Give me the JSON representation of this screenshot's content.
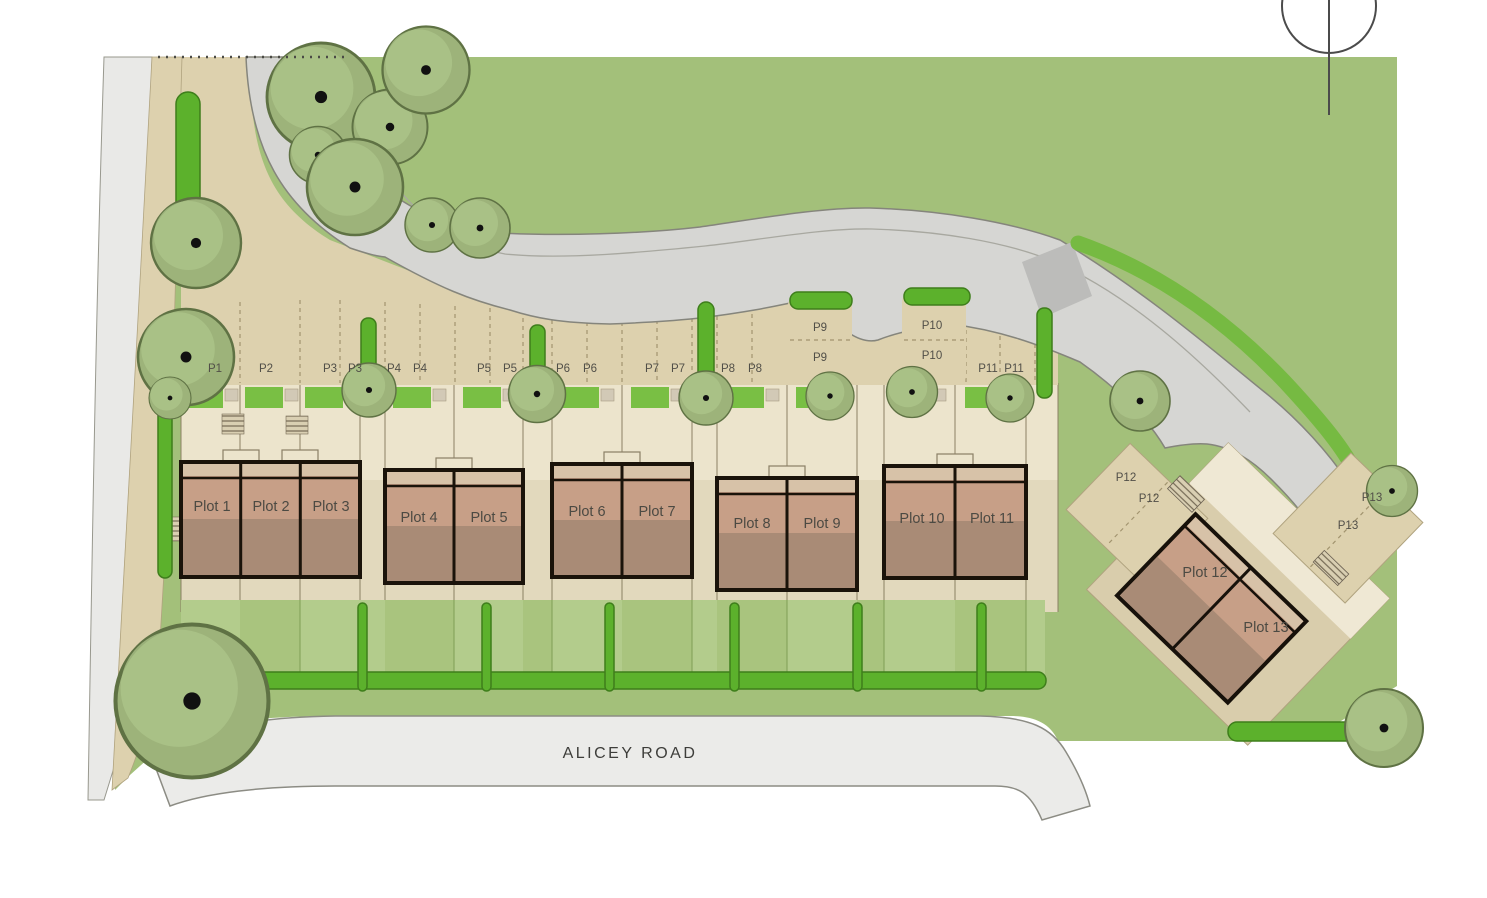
{
  "title": "Residential development site layout plan",
  "road_name": "ALICEY ROAD",
  "plots": [
    "Plot 1",
    "Plot 2",
    "Plot 3",
    "Plot 4",
    "Plot 5",
    "Plot 6",
    "Plot 7",
    "Plot 8",
    "Plot 9",
    "Plot 10",
    "Plot 11",
    "Plot 12",
    "Plot 13"
  ],
  "parking": [
    "P1",
    "P2",
    "P3",
    "P4",
    "P5",
    "P6",
    "P7",
    "P8",
    "P9",
    "P10",
    "P11",
    "P12",
    "P13"
  ],
  "icons": {
    "north_arrow": "north-arrow",
    "tree": "tree",
    "hedge": "hedge",
    "shrub": "shrub"
  },
  "colors": {
    "site_green": "#a3c07a",
    "bright_green": "#5cb12c",
    "garden_green": "#b3cc8c",
    "road_gray": "#d6d6d3",
    "street_gray": "#ebebe9",
    "parking_tan": "#ddd1ae",
    "paving_cream": "#ece4cc",
    "house_top_strip": "#d7c2a8",
    "house_face": "#c79f87",
    "house_rear": "#a98b76",
    "outline_black": "#1a130a"
  }
}
